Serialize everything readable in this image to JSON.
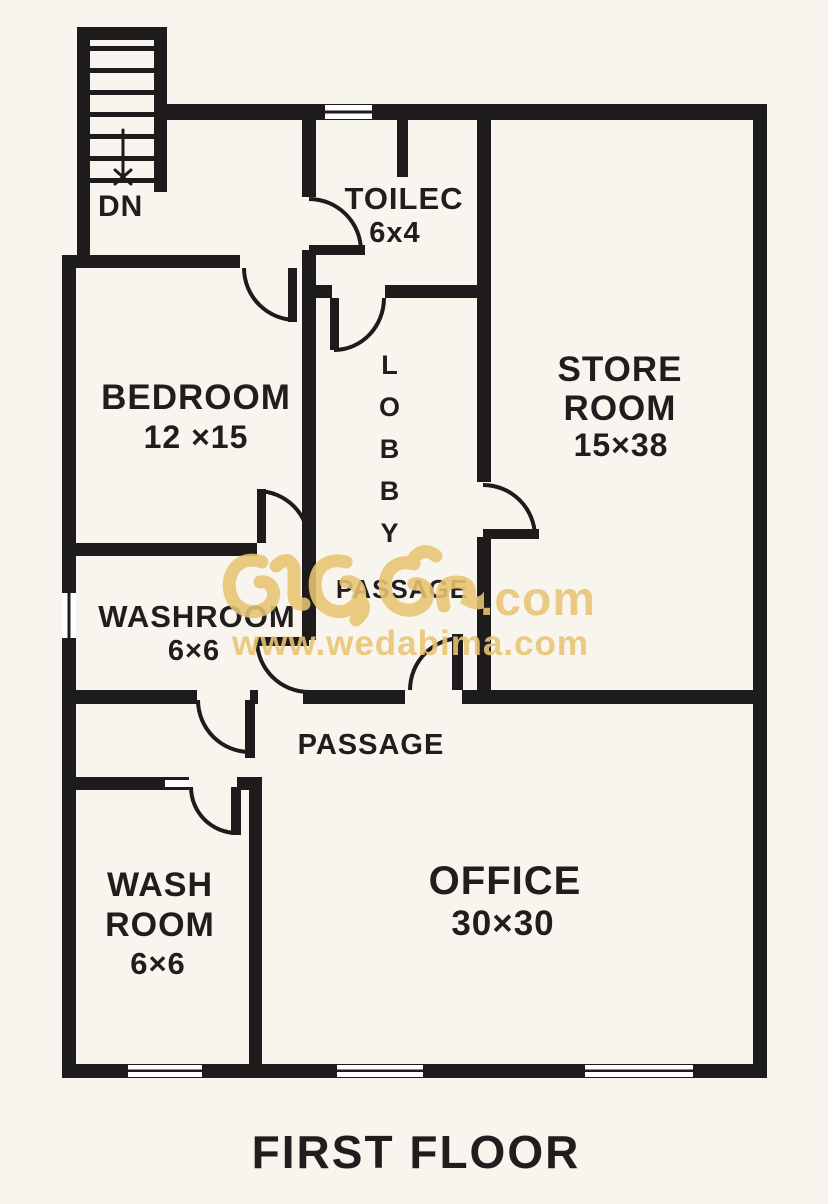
{
  "title": "FIRST FLOOR",
  "stairs": {
    "label": "DN"
  },
  "rooms": {
    "toilet": {
      "name": "TOILEC",
      "dims": "6x4"
    },
    "bedroom": {
      "name": "BEDROOM",
      "dims": "12 ×15"
    },
    "store": {
      "line1": "STORE",
      "line2": "ROOM",
      "dims": "15×38"
    },
    "lobby": {
      "name": "LOBBY"
    },
    "washroom": {
      "name": "WASHROOM",
      "dims": "6×6"
    },
    "passage_upper": {
      "name": "PASSAGE"
    },
    "passage_lower": {
      "name": "PASSAGE"
    },
    "wash_room": {
      "line1": "WASH",
      "line2": "ROOM",
      "dims": "6×6"
    },
    "office": {
      "name": "OFFICE",
      "dims": "30×30"
    }
  },
  "watermark": {
    "script_word": "වැඩබිම",
    "suffix": ".com",
    "url": "www.wedabima.com",
    "color": "#e9c473"
  },
  "colors": {
    "wall": "#1d1b1b",
    "background": "#f8f4ee",
    "text": "#1f1d1d"
  }
}
